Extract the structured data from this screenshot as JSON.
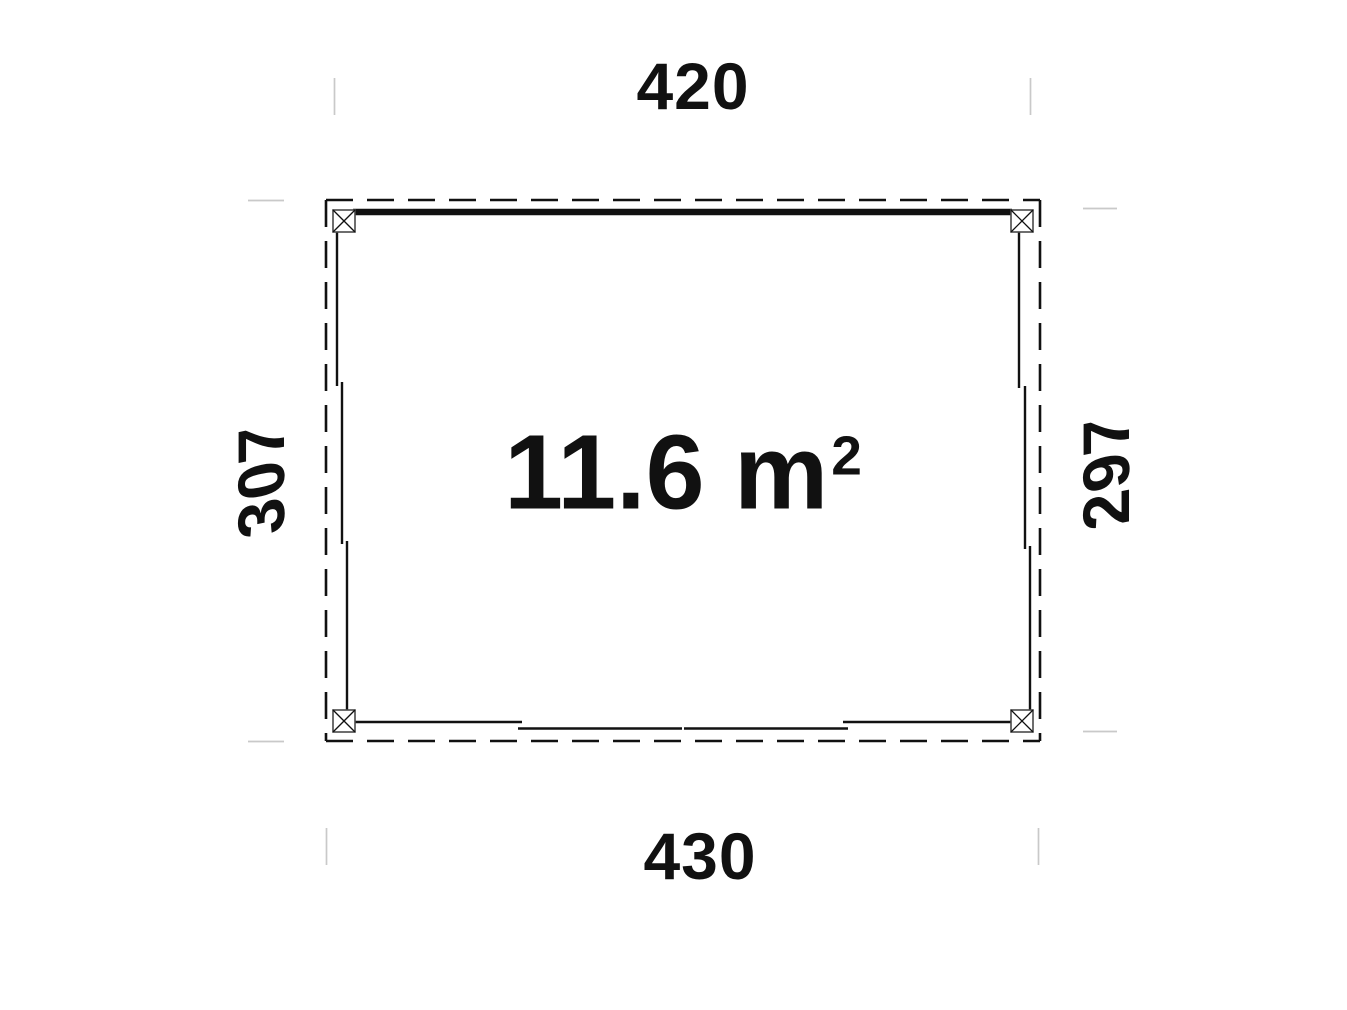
{
  "plan": {
    "dimensions": {
      "top": "420",
      "bottom": "430",
      "left": "307",
      "right": "297"
    },
    "area": {
      "main": "11.6 m",
      "exponent": "2",
      "full": "11.6 m²"
    },
    "colors": {
      "line": "#111111",
      "post_border": "#4a4a4a",
      "tick": "#c9c9c9",
      "background": "#ffffff"
    }
  }
}
